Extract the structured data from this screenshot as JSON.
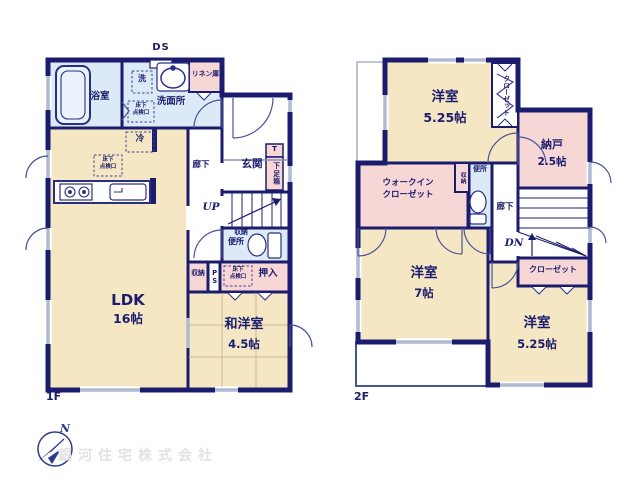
{
  "meta": {
    "ds_label": "DS",
    "up_label": "UP",
    "dn_label": "DN",
    "compass_n": "N",
    "company": "銀河住宅株式会社",
    "floor1_label": "1F",
    "floor2_label": "2F"
  },
  "palette": {
    "wall": "#1c1c6e",
    "room_cream": "#f6e7c4",
    "room_pink": "#f7d6d6",
    "room_blue": "#dce9f6",
    "window": "#aebad2",
    "watermark_text": "#e2e2e2",
    "compass": "#2b3990"
  },
  "floor1": {
    "hatch_line1": "床下",
    "hatch_line2": "点検口",
    "rooms": {
      "bath": "浴室",
      "washer": "洗",
      "linen": "リネン庫",
      "washroom": "洗面所",
      "fridge": "冷",
      "hallway": "廊下",
      "entrance": "玄関",
      "shoe_t": "T",
      "shoe_box": "下足箱",
      "storage_wc": "収納",
      "toilet": "便所",
      "storage": "収納",
      "ps": "PS",
      "oshiire": "押入",
      "ldk": "LDK",
      "ldk_size": "16帖",
      "washitsu": "和洋室",
      "washitsu_size": "4.5帖"
    }
  },
  "floor2": {
    "rooms": {
      "bedroom1": "洋室",
      "bedroom1_size": "5.25帖",
      "closet1": "クローゼット",
      "nando": "納戸",
      "nando_size": "2.5帖",
      "wic_line1": "ウォークイン",
      "wic_line2": "クローゼット",
      "storage": "収納",
      "toilet": "便所",
      "hallway": "廊下",
      "closet2": "クローゼット",
      "bedroom2": "洋室",
      "bedroom2_size": "7帖",
      "bedroom3": "洋室",
      "bedroom3_size": "5.25帖"
    }
  }
}
